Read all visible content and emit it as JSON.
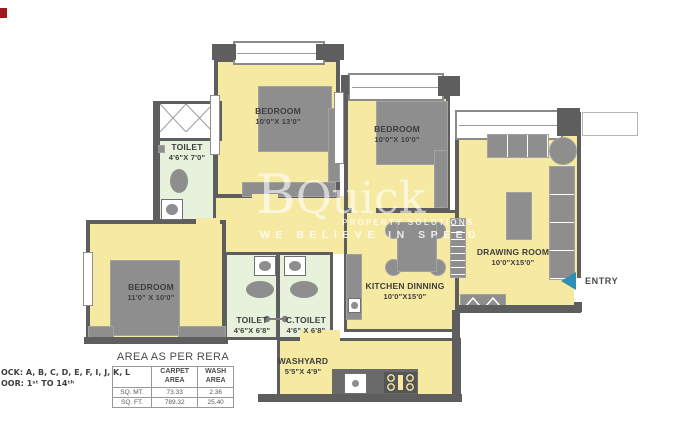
{
  "colors": {
    "wall": "#5E5E5E",
    "room_fill": "#F6E9A1",
    "toilet_fill": "#E7F1DC",
    "furniture": "#8E8E8E",
    "entry_arrow": "#2E8FB4",
    "marker": "#9E1B1B"
  },
  "watermark": {
    "brand_initial": "B",
    "brand_rest": "Quick",
    "subtitle": "PROPERTY SOLUTIONS",
    "tagline": "WE BELIEVE IN SPEED"
  },
  "rooms": {
    "bedroom_top": {
      "name": "BEDROOM",
      "dims": "10'0\"X 13'0\""
    },
    "bedroom_right": {
      "name": "BEDROOM",
      "dims": "10'0\"X 10'0\""
    },
    "bedroom_left": {
      "name": "BEDROOM",
      "dims": "11'0\" X 10'0\""
    },
    "toilet_top": {
      "name": "TOILET",
      "dims": "4'6\"X 7'0\""
    },
    "toilet_bottom": {
      "name": "TOILET",
      "dims": "4'6\"X 6'8\""
    },
    "c_toilet": {
      "name": "C.TOILET",
      "dims": "4'6\" X 6'8\""
    },
    "kitchen": {
      "name": "KITCHEN DINNING",
      "dims": "10'0\"X15'0\""
    },
    "drawing": {
      "name": "DRAWING ROOM",
      "dims": "10'0\"X15'0\""
    },
    "washyard": {
      "name": "WASHYARD",
      "dims": "5'5\"X 4'9\""
    }
  },
  "entry": {
    "label": "ENTRY"
  },
  "block_note": {
    "line1": "OCK: A, B, C, D, E, F, I, J, K, L",
    "line2": "OOR: 1ˢᵗ TO 14ᵗʰ"
  },
  "area_table": {
    "title": "AREA AS PER RERA",
    "col_carpet": "CARPET\nAREA",
    "col_wash": "WASH\nAREA",
    "rows": [
      {
        "unit": "SQ. MT.",
        "carpet": "73.33",
        "wash": "2.36"
      },
      {
        "unit": "SQ. FT.",
        "carpet": "789.32",
        "wash": "25.40"
      }
    ]
  }
}
